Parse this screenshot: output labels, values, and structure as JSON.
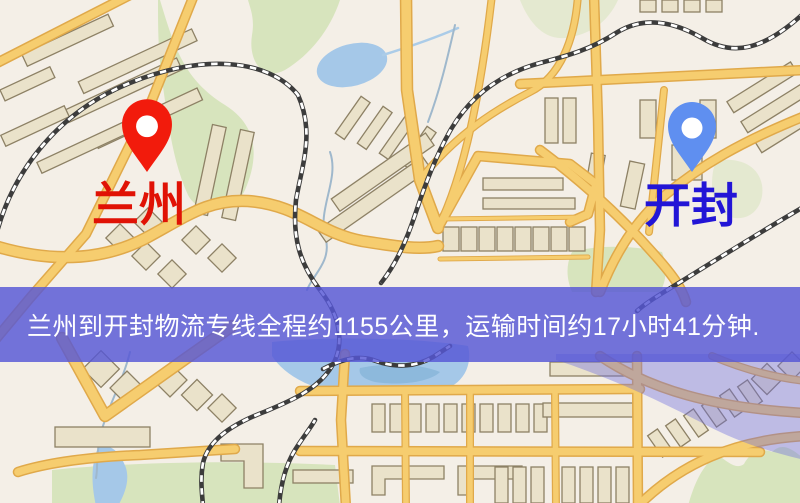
{
  "map": {
    "origin_label": {
      "text": "兰州"
    },
    "destination_label": {
      "text": "开封"
    }
  },
  "banner": {
    "text": "兰州到开封物流专线全程约1155公里，运输时间约17小时41分钟."
  },
  "colors": {
    "map_background": "#f4efe7",
    "road_fill": "#f6cd6f",
    "road_casing": "#e0a94a",
    "building_fill": "#eae2ca",
    "building_stroke": "#8d8165",
    "park_green": "#d7e4bd",
    "water_blue": "#a5c8e8",
    "railway_dark": "#3c3c3c",
    "banner_background": "#5557d6",
    "banner_text": "#ffffff",
    "origin_pin": "#f21b0c",
    "origin_label": "#e01205",
    "destination_pin": "#5f8ff0",
    "destination_label": "#2215d6",
    "overlay_tint": "#6e6fe0"
  }
}
